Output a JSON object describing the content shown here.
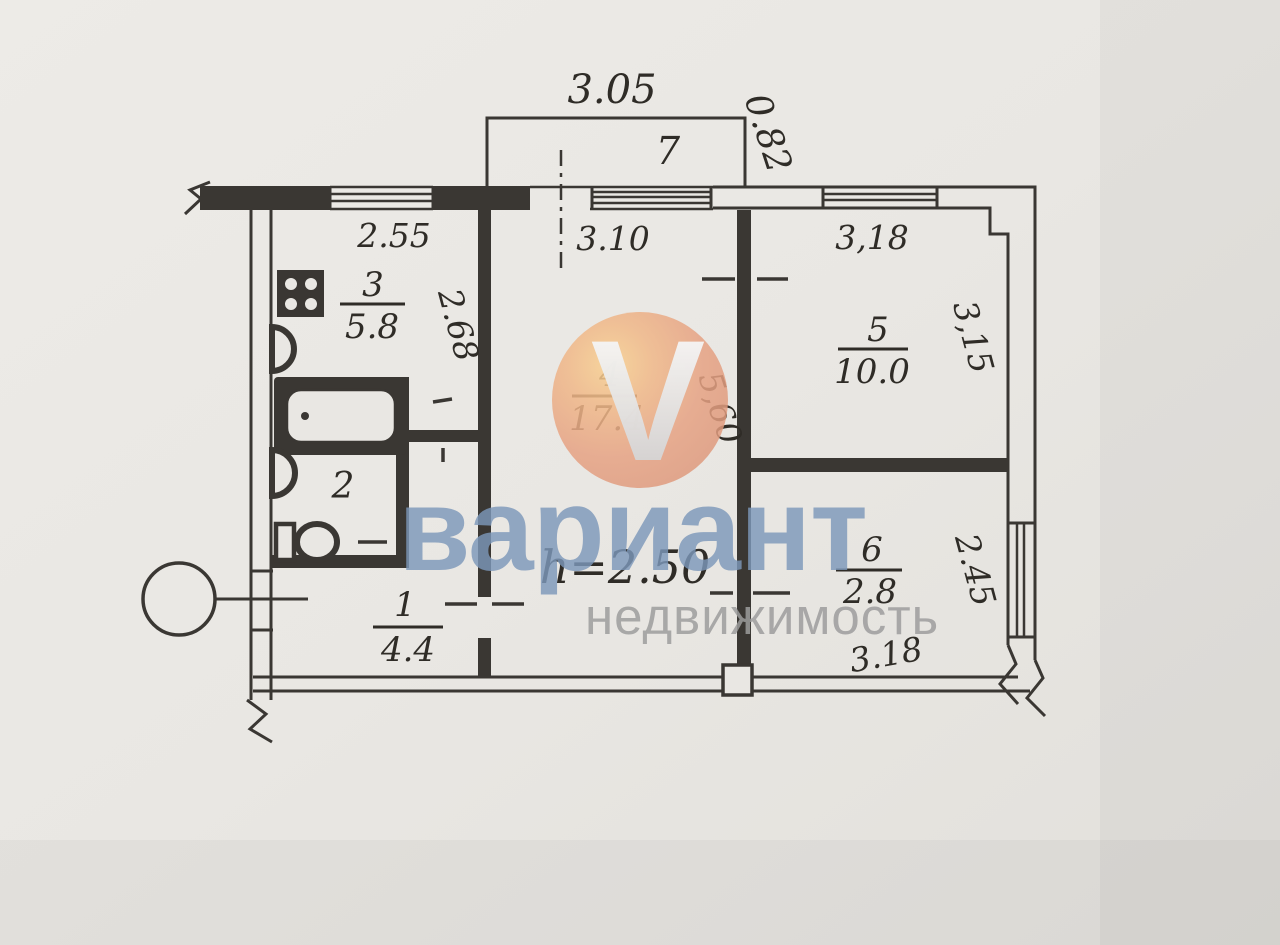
{
  "watermark": {
    "v_letter": "V",
    "brand": "вариант",
    "subtitle": "недвижимость",
    "circle_color": "#e2a07e",
    "brand_color": "#7d97ba",
    "subtitle_color": "#9c9c9c"
  },
  "dimensions": {
    "balcony_width": "3.05",
    "balcony_depth": "0.82",
    "kitchen_width": "2.55",
    "kitchen_depth": "2.68",
    "room4_width": "3.10",
    "room4_depth": "5,60",
    "room5_width": "3,18",
    "room5_depth": "3,15",
    "room6_depth": "2.45",
    "room6_width": "3.18",
    "ceiling_height": "h=2.50"
  },
  "rooms": {
    "hall": {
      "number": "1",
      "area": "4.4"
    },
    "bathroom": {
      "number": "2"
    },
    "kitchen": {
      "number": "3",
      "area": "5.8"
    },
    "living": {
      "number": "4",
      "area": "17.4"
    },
    "bedroom": {
      "number": "5",
      "area": "10.0"
    },
    "storage": {
      "number": "6",
      "area": "2.8"
    },
    "balcony": {
      "number": "7"
    }
  }
}
